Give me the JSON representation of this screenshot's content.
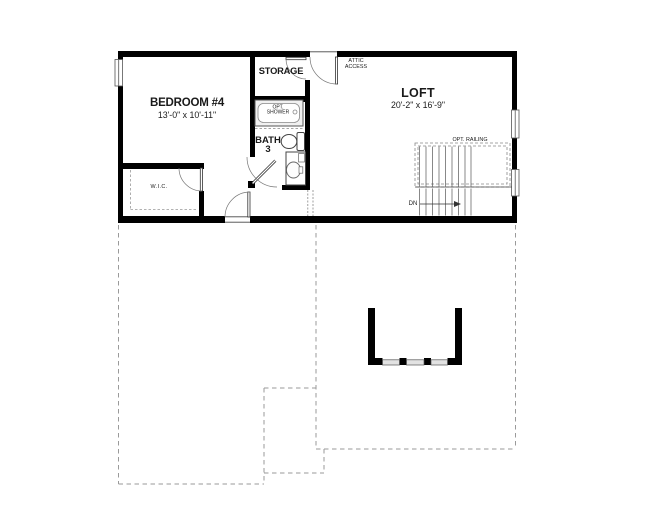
{
  "floor_plan": {
    "rooms": {
      "bedroom4": {
        "label": "BEDROOM #4",
        "dimensions": "13'-0\" x 10'-11\""
      },
      "loft": {
        "label": "LOFT",
        "dimensions": "20'-2\" x 16'-9\""
      },
      "storage": {
        "label": "STORAGE"
      },
      "bath3": {
        "label": "BATH",
        "number": "3"
      },
      "wic": {
        "label": "W.I.C."
      },
      "attic_access": {
        "label_line1": "ATTIC",
        "label_line2": "ACCESS"
      }
    },
    "annotations": {
      "opt_shower_line1": "OPT.",
      "opt_shower_line2": "SHOWER",
      "opt_railing": "OPT. RAILING",
      "stair_direction": "DN"
    },
    "colors": {
      "background": "#ffffff",
      "walls": "#000000",
      "thin_lines": "#444444",
      "door_arcs": "#777777",
      "dashed_outline": "#9a9a9a",
      "window_fill": "#e2e2e2",
      "fixture_fill": "#f1f1f1",
      "text": "#1a1a1a"
    }
  }
}
